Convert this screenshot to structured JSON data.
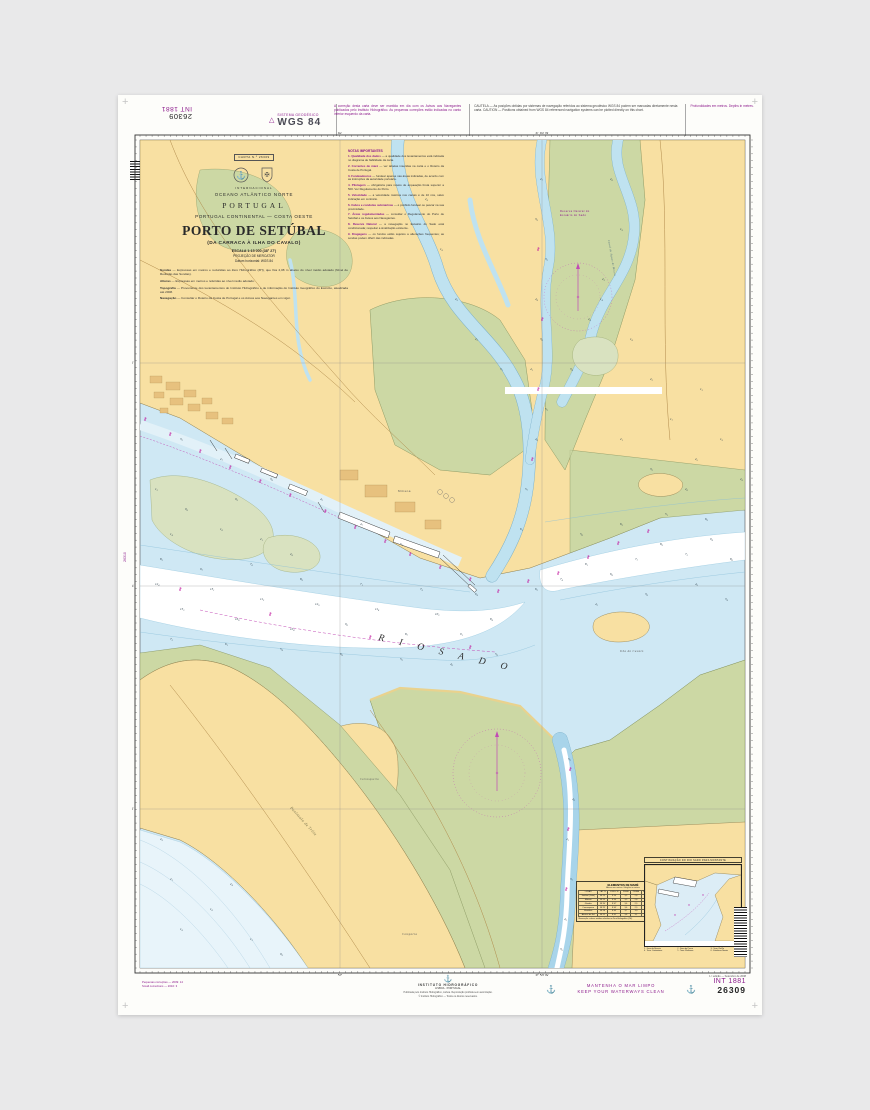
{
  "margins": {
    "top_left_chart_no": "26309",
    "top_left_int_no": "INT 1881",
    "geodetic_small": "SISTEMA GEODÉSICO",
    "geodetic_big": "WGS 84",
    "note_update": "A correção desta carta deve ser mantida em dia com os Avisos aos Navegantes publicados pelo Instituto Hidrográfico. As pequenas correções estão indicadas no canto inferior esquerdo da carta.",
    "note_caution": "CAUTELA — As posições obtidas por sistemas de navegação referidos ao sistema geodésico WGS 84 podem ser marcadas diretamente nesta carta.  CAUTION — Positions obtained from WGS 84 referenced navigation systems can be plotted directly on this chart.",
    "note_right": "Profundidades em metros. Depths in metres.",
    "small_corrections_1": "Pequenas correções — 2009: 14",
    "small_corrections_2": "Small corrections — 2010: 3",
    "publisher_name": "INSTITUTO HIDROGRÁFICO",
    "publisher_line1": "LISBOA · PORTUGAL",
    "publisher_line2": "Publicada pelo Instituto Hidrográfico, Lisboa. Reprodução proibida sem autorização.",
    "publisher_line3": "© Instituto Hidrográfico — Todos os direitos reservados.",
    "clean_sea_pt": "MANTENHA O MAR LIMPO",
    "clean_sea_en": "KEEP YOUR WATERWAYS CLEAN",
    "edition": "1.ª edição — Setembro de 2008",
    "int_no": "INT 1881",
    "chart_no": "26309",
    "adjoining_chart": "26310"
  },
  "title_block": {
    "carta": "CARTA N.º 26309",
    "intl": "INTERNACIONAL",
    "ocean": "OCEANO ATLÂNTICO NORTE",
    "country": "PORTUGAL",
    "region": "PORTUGAL CONTINENTAL — COSTA OESTE",
    "title": "PORTO DE SETÚBAL",
    "subtitle": "(DA CARRACA À ILHA DO CAVALO)",
    "scale": "ESCALA 1:15 000 (38° 27')",
    "projection": "PROJEÇÃO DE MERCATOR",
    "datum": "Datum horizontal: WGS 84",
    "paragraphs": [
      {
        "lead": "Sondas",
        "text": " — Expressas em metros e reduzidas ao Zero Hidrográfico (ZH), que fica 2,08 m abaixo do nível médio adotado (Nível de Redução das Sondas)."
      },
      {
        "lead": "Alturas",
        "text": " — Expressas em metros e referidas ao nível médio adotado."
      },
      {
        "lead": "Topografia",
        "text": " — Proveniente dos levantamentos do Instituto Hidrográfico e de informação do Instituto Geográfico do Exército, atualizada até 2008."
      },
      {
        "lead": "Navegação",
        "text": " — Consultar o Roteiro da Costa de Portugal e os Avisos aos Navegantes em vigor."
      }
    ]
  },
  "notes": {
    "heading": "NOTAS IMPORTANTES",
    "items": [
      {
        "num": "1.",
        "lead": "Qualidade dos dados",
        "text": " — a qualidade dos levantamentos está indicada no diagrama de fiabilidade da carta."
      },
      {
        "num": "2.",
        "lead": "Correntes de maré",
        "text": " — ver tabelas inseridas na carta e o Roteiro da Costa de Portugal."
      },
      {
        "num": "3.",
        "lead": "Fundeadouros",
        "text": " — fundear apenas nas áreas indicadas, de acordo com as instruções da autoridade portuária."
      },
      {
        "num": "4.",
        "lead": "Pilotagem",
        "text": " — obrigatória para navios de arqueação bruta superior a 500. Ver Regulamento do Porto."
      },
      {
        "num": "5.",
        "lead": "Velocidade",
        "text": " — a velocidade máxima nos canais é de 10 nós, salvo indicação em contrário."
      },
      {
        "num": "6.",
        "lead": "Cabos e condutas submarinas",
        "text": " — é proibido fundear ou pescar na sua proximidade."
      },
      {
        "num": "7.",
        "lead": "Áreas regulamentadas",
        "text": " — consultar o Regulamento do Porto de Setúbal e os Avisos aos Navegantes."
      },
      {
        "num": "8.",
        "lead": "Reserva Natural",
        "text": " — a navegação no Estuário do Sado está condicionada; respeitar a sinalização existente."
      },
      {
        "num": "9.",
        "lead": "Dragagens",
        "text": " — os fundos estão sujeitos a alterações frequentes; as sondas podem diferir das indicadas."
      }
    ]
  },
  "map": {
    "rio_sado": "R I O   S A D O",
    "graticule_top": [
      {
        "x": 200,
        "t": "52'"
      },
      {
        "x": 402,
        "t": "8° 50' W"
      }
    ],
    "graticule_left": [
      {
        "y": 223,
        "t": "30'"
      },
      {
        "y": 446,
        "t": "38° 29' N"
      },
      {
        "y": 669,
        "t": "28'"
      }
    ],
    "labels": [
      {
        "t": "Península de Tróia",
        "x": 150,
        "y": 668,
        "r": 48,
        "s": 4,
        "c": "#77704a",
        "i": 1
      },
      {
        "t": "Ilha do Cavalo",
        "x": 480,
        "y": 512,
        "r": 0,
        "s": 3,
        "c": "#555",
        "i": 1
      },
      {
        "t": "Canal de Águas de Moura",
        "x": 468,
        "y": 100,
        "r": 80,
        "s": 2.6,
        "c": "#4a6a7a",
        "i": 1
      },
      {
        "t": "Mitrena",
        "x": 258,
        "y": 352,
        "r": 0,
        "s": 3,
        "c": "#555",
        "i": 0
      },
      {
        "t": "Reserva Natural do",
        "x": 420,
        "y": 72,
        "r": 0,
        "s": 2.6,
        "c": "#8c1a8c",
        "i": 0
      },
      {
        "t": "Estuário do Sado",
        "x": 420,
        "y": 76,
        "r": 0,
        "s": 2.6,
        "c": "#8c1a8c",
        "i": 0
      },
      {
        "t": "Carrasqueira",
        "x": 220,
        "y": 640,
        "r": 0,
        "s": 2.6,
        "c": "#555",
        "i": 1
      },
      {
        "t": "Comporta",
        "x": 262,
        "y": 795,
        "r": 0,
        "s": 3,
        "c": "#555",
        "i": 1
      }
    ],
    "soundings": [
      [
        15,
        445,
        "12.4"
      ],
      [
        40,
        470,
        "15.2"
      ],
      [
        70,
        450,
        "13.1"
      ],
      [
        95,
        480,
        "16.8"
      ],
      [
        120,
        460,
        "11.2"
      ],
      [
        150,
        490,
        "10.4"
      ],
      [
        175,
        465,
        "12.9"
      ],
      [
        205,
        485,
        "9.6"
      ],
      [
        235,
        470,
        "11.8"
      ],
      [
        265,
        495,
        "8.7"
      ],
      [
        295,
        475,
        "10.2"
      ],
      [
        320,
        495,
        "9.1"
      ],
      [
        350,
        480,
        "8.4"
      ],
      [
        30,
        500,
        "7.2"
      ],
      [
        85,
        505,
        "6.1"
      ],
      [
        140,
        510,
        "5.4"
      ],
      [
        200,
        515,
        "6.8"
      ],
      [
        260,
        520,
        "5.2"
      ],
      [
        310,
        525,
        "4.6"
      ],
      [
        355,
        515,
        "5.8"
      ],
      [
        20,
        420,
        "8.3"
      ],
      [
        60,
        430,
        "9.7"
      ],
      [
        110,
        425,
        "7.6"
      ],
      [
        160,
        440,
        "8.9"
      ],
      [
        220,
        445,
        "7.1"
      ],
      [
        280,
        450,
        "7.9"
      ],
      [
        335,
        455,
        "6.4"
      ],
      [
        15,
        350,
        "1.2"
      ],
      [
        45,
        370,
        "0.8"
      ],
      [
        80,
        390,
        "1.6"
      ],
      [
        120,
        400,
        "2.1"
      ],
      [
        30,
        395,
        "1.4"
      ],
      [
        95,
        360,
        "0.9"
      ],
      [
        150,
        415,
        "2.8"
      ],
      [
        395,
        450,
        "6.2"
      ],
      [
        420,
        440,
        "7.4"
      ],
      [
        445,
        425,
        "8.1"
      ],
      [
        470,
        435,
        "6.8"
      ],
      [
        495,
        420,
        "7.7"
      ],
      [
        520,
        405,
        "8.9"
      ],
      [
        545,
        415,
        "7.2"
      ],
      [
        570,
        400,
        "9.4"
      ],
      [
        590,
        420,
        "8.6"
      ],
      [
        455,
        465,
        "4.2"
      ],
      [
        505,
        455,
        "3.8"
      ],
      [
        555,
        445,
        "4.9"
      ],
      [
        585,
        460,
        "3.4"
      ],
      [
        440,
        395,
        "5.6"
      ],
      [
        480,
        385,
        "6.3"
      ],
      [
        525,
        375,
        "5.1"
      ],
      [
        565,
        380,
        "6.9"
      ],
      [
        395,
        300,
        "4.8"
      ],
      [
        405,
        270,
        "5.3"
      ],
      [
        390,
        230,
        "4.1"
      ],
      [
        400,
        200,
        "3.6"
      ],
      [
        395,
        160,
        "4.4"
      ],
      [
        405,
        120,
        "3.2"
      ],
      [
        395,
        80,
        "3.9"
      ],
      [
        400,
        40,
        "2.7"
      ],
      [
        385,
        350,
        "5.7"
      ],
      [
        380,
        390,
        "6.1"
      ],
      [
        285,
        60,
        "2.4"
      ],
      [
        300,
        110,
        "1.8"
      ],
      [
        315,
        160,
        "2.9"
      ],
      [
        335,
        200,
        "2.2"
      ],
      [
        360,
        230,
        "3.1"
      ],
      [
        470,
        40,
        "2.6"
      ],
      [
        480,
        90,
        "1.9"
      ],
      [
        462,
        140,
        "2.3"
      ],
      [
        448,
        180,
        "2.8"
      ],
      [
        430,
        230,
        "3.4"
      ],
      [
        428,
        620,
        "5.2"
      ],
      [
        432,
        660,
        "4.6"
      ],
      [
        426,
        700,
        "4.1"
      ],
      [
        430,
        740,
        "3.7"
      ],
      [
        424,
        780,
        "4.3"
      ],
      [
        420,
        810,
        "3.5"
      ],
      [
        30,
        740,
        "2.1"
      ],
      [
        70,
        770,
        "1.6"
      ],
      [
        110,
        800,
        "1.2"
      ],
      [
        40,
        790,
        "1.8"
      ],
      [
        90,
        745,
        "2.4"
      ],
      [
        20,
        700,
        "2.9"
      ],
      [
        140,
        815,
        "0.9"
      ],
      [
        40,
        300,
        "3.2"
      ],
      [
        80,
        320,
        "2.7"
      ],
      [
        130,
        340,
        "3.8"
      ],
      [
        180,
        360,
        "4.2"
      ],
      [
        220,
        385,
        "4.7"
      ],
      [
        260,
        405,
        "5.1"
      ],
      [
        460,
        160,
        "1.4"
      ],
      [
        490,
        200,
        "1.8"
      ],
      [
        510,
        240,
        "2.2"
      ],
      [
        530,
        280,
        "1.7"
      ],
      [
        555,
        320,
        "2.5"
      ],
      [
        580,
        300,
        "1.9"
      ],
      [
        560,
        250,
        "1.3"
      ],
      [
        600,
        340,
        "2.8"
      ],
      [
        480,
        300,
        "2.1"
      ],
      [
        510,
        330,
        "3.2"
      ],
      [
        545,
        350,
        "2.6"
      ]
    ],
    "buoys": [
      [
        5,
        280
      ],
      [
        30,
        295
      ],
      [
        60,
        312
      ],
      [
        90,
        328
      ],
      [
        120,
        342
      ],
      [
        150,
        356
      ],
      [
        185,
        372
      ],
      [
        215,
        388
      ],
      [
        245,
        402
      ],
      [
        270,
        415
      ],
      [
        300,
        428
      ],
      [
        330,
        440
      ],
      [
        358,
        452
      ],
      [
        388,
        442
      ],
      [
        418,
        434
      ],
      [
        448,
        418
      ],
      [
        478,
        404
      ],
      [
        508,
        392
      ],
      [
        40,
        450
      ],
      [
        130,
        475
      ],
      [
        230,
        498
      ],
      [
        330,
        508
      ],
      [
        392,
        320
      ],
      [
        398,
        250
      ],
      [
        402,
        180
      ],
      [
        398,
        110
      ],
      [
        430,
        630
      ],
      [
        428,
        690
      ],
      [
        426,
        750
      ]
    ]
  },
  "tide_table": {
    "title": "ELEMENTOS DE MARÉ",
    "subtitle": "Alturas em metros / Heights in metres",
    "head": [
      "LUGAR",
      "LAT. N",
      "LONG. W",
      "PM AV",
      "PM AM",
      "BM AM",
      "BM AV",
      "NM"
    ],
    "rows": [
      [
        "Setúbal (Tróia)",
        "38°29'",
        "8°54'",
        "3,5",
        "2,8",
        "1,4",
        "0,6",
        "2,1"
      ],
      [
        "Mitrena",
        "38°29'",
        "8°50'",
        "3,5",
        "2,8",
        "1,4",
        "0,6",
        "2,1"
      ],
      [
        "Gâmbia",
        "38°30'",
        "8°47'",
        "3,6",
        "2,9",
        "1,4",
        "0,6",
        "2,1"
      ],
      [
        "Carrasqueira",
        "38°25'",
        "8°45'",
        "3,6",
        "2,9",
        "1,5",
        "0,7",
        "2,2"
      ],
      [
        "Montalvo",
        "38°28'",
        "8°43'",
        "3,7",
        "3,0",
        "1,5",
        "0,7",
        "2,2"
      ],
      [
        "Alcácer do Sal",
        "38°22'",
        "8°31'",
        "3,8",
        "3,1",
        "1,6",
        "0,8",
        "2,3"
      ]
    ],
    "footnote": "Observação: valores médios referidos ao Zero Hidrográfico (ZH)."
  },
  "inset": {
    "title": "CONTINUAÇÃO DO RIO SADO PARA MONTANTE",
    "legend": [
      "1 · Doca de Recreio",
      "2 · Doca de Pesca",
      "3 · Term. Ro-Ro",
      "4 · Term. Contentores",
      "5 · Term. Multiusos",
      "6 · Estaleiros Navais"
    ]
  }
}
